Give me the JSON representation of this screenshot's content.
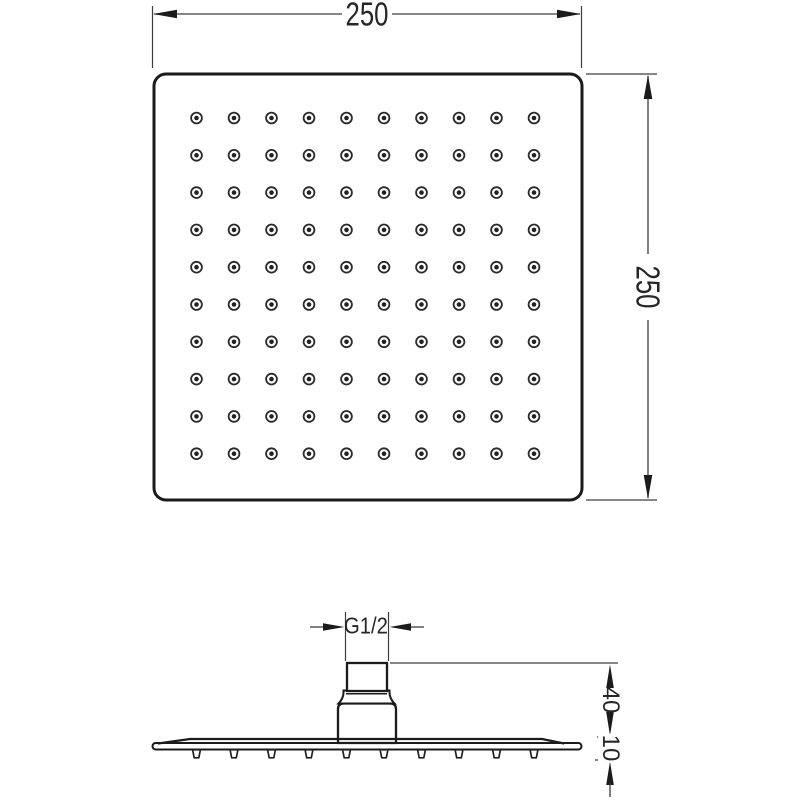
{
  "dimensions": {
    "width": "250",
    "height": "250",
    "thread": "G1/2",
    "connector_height": "40",
    "plate_thickness": "10"
  },
  "top_view": {
    "nozzle_rows": 10,
    "nozzle_cols": 10
  },
  "side_view": {
    "nozzle_count": 10
  },
  "colors": {
    "line": "#1b1b1b",
    "dim": "#3d3d3d",
    "background": "#ffffff"
  }
}
